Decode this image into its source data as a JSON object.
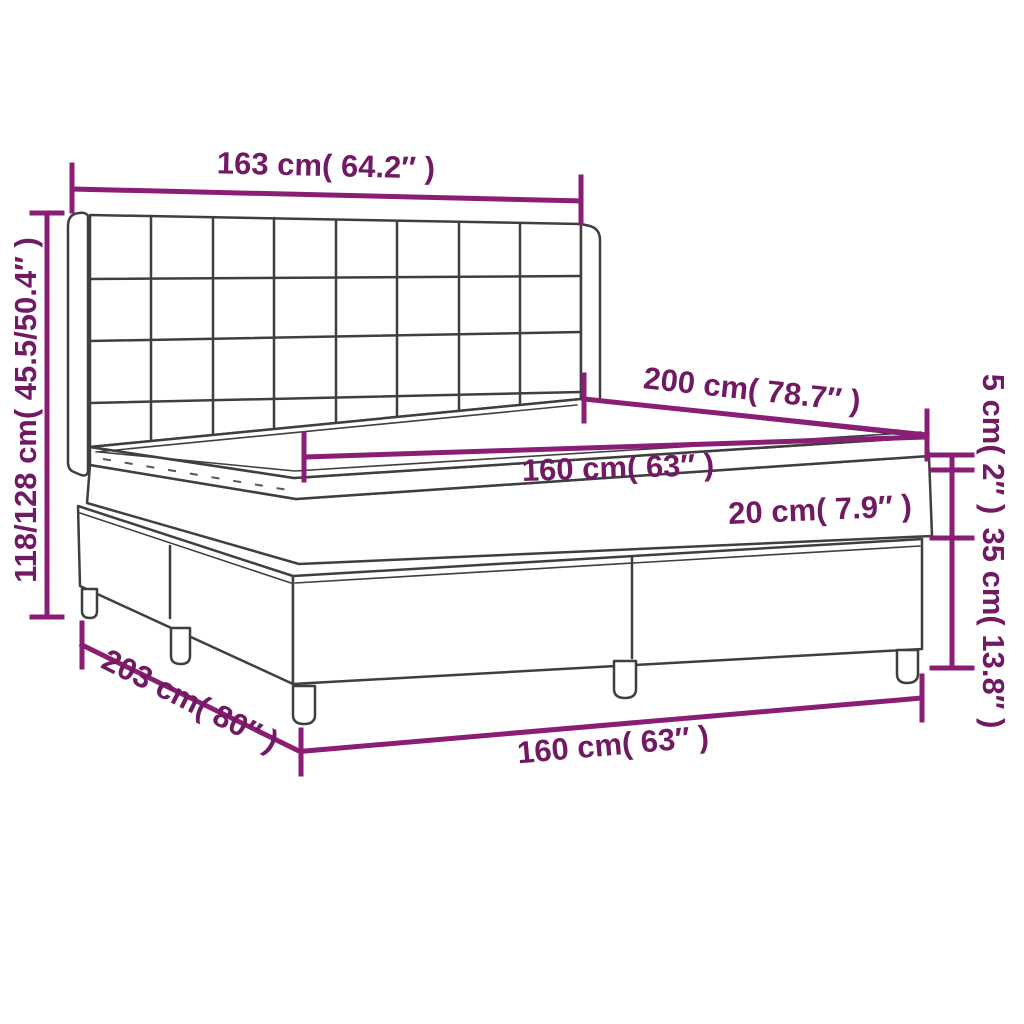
{
  "diagram": {
    "subject": "box spring bed with tufted headboard and mattress topper",
    "colors": {
      "dimension_line": "#8a1e74",
      "dimension_text": "#701a63",
      "drawing_outline": "#3f3f3f",
      "background": "#ffffff"
    },
    "dimensions": {
      "headboard_width": "163 cm( 64.2″ )",
      "headboard_height": "118/128 cm( 45.5/50.4″ )",
      "mattress_length": "200 cm( 78.7″ )",
      "mattress_width": "160 cm( 63″ )",
      "mattress_height": "20 cm( 7.9″ )",
      "topper_height": "5 cm( 2″ )",
      "base_height": "35 cm( 13.8″ )",
      "bed_length": "203 cm( 80″ )",
      "bed_width": "160 cm( 63″ )"
    }
  }
}
